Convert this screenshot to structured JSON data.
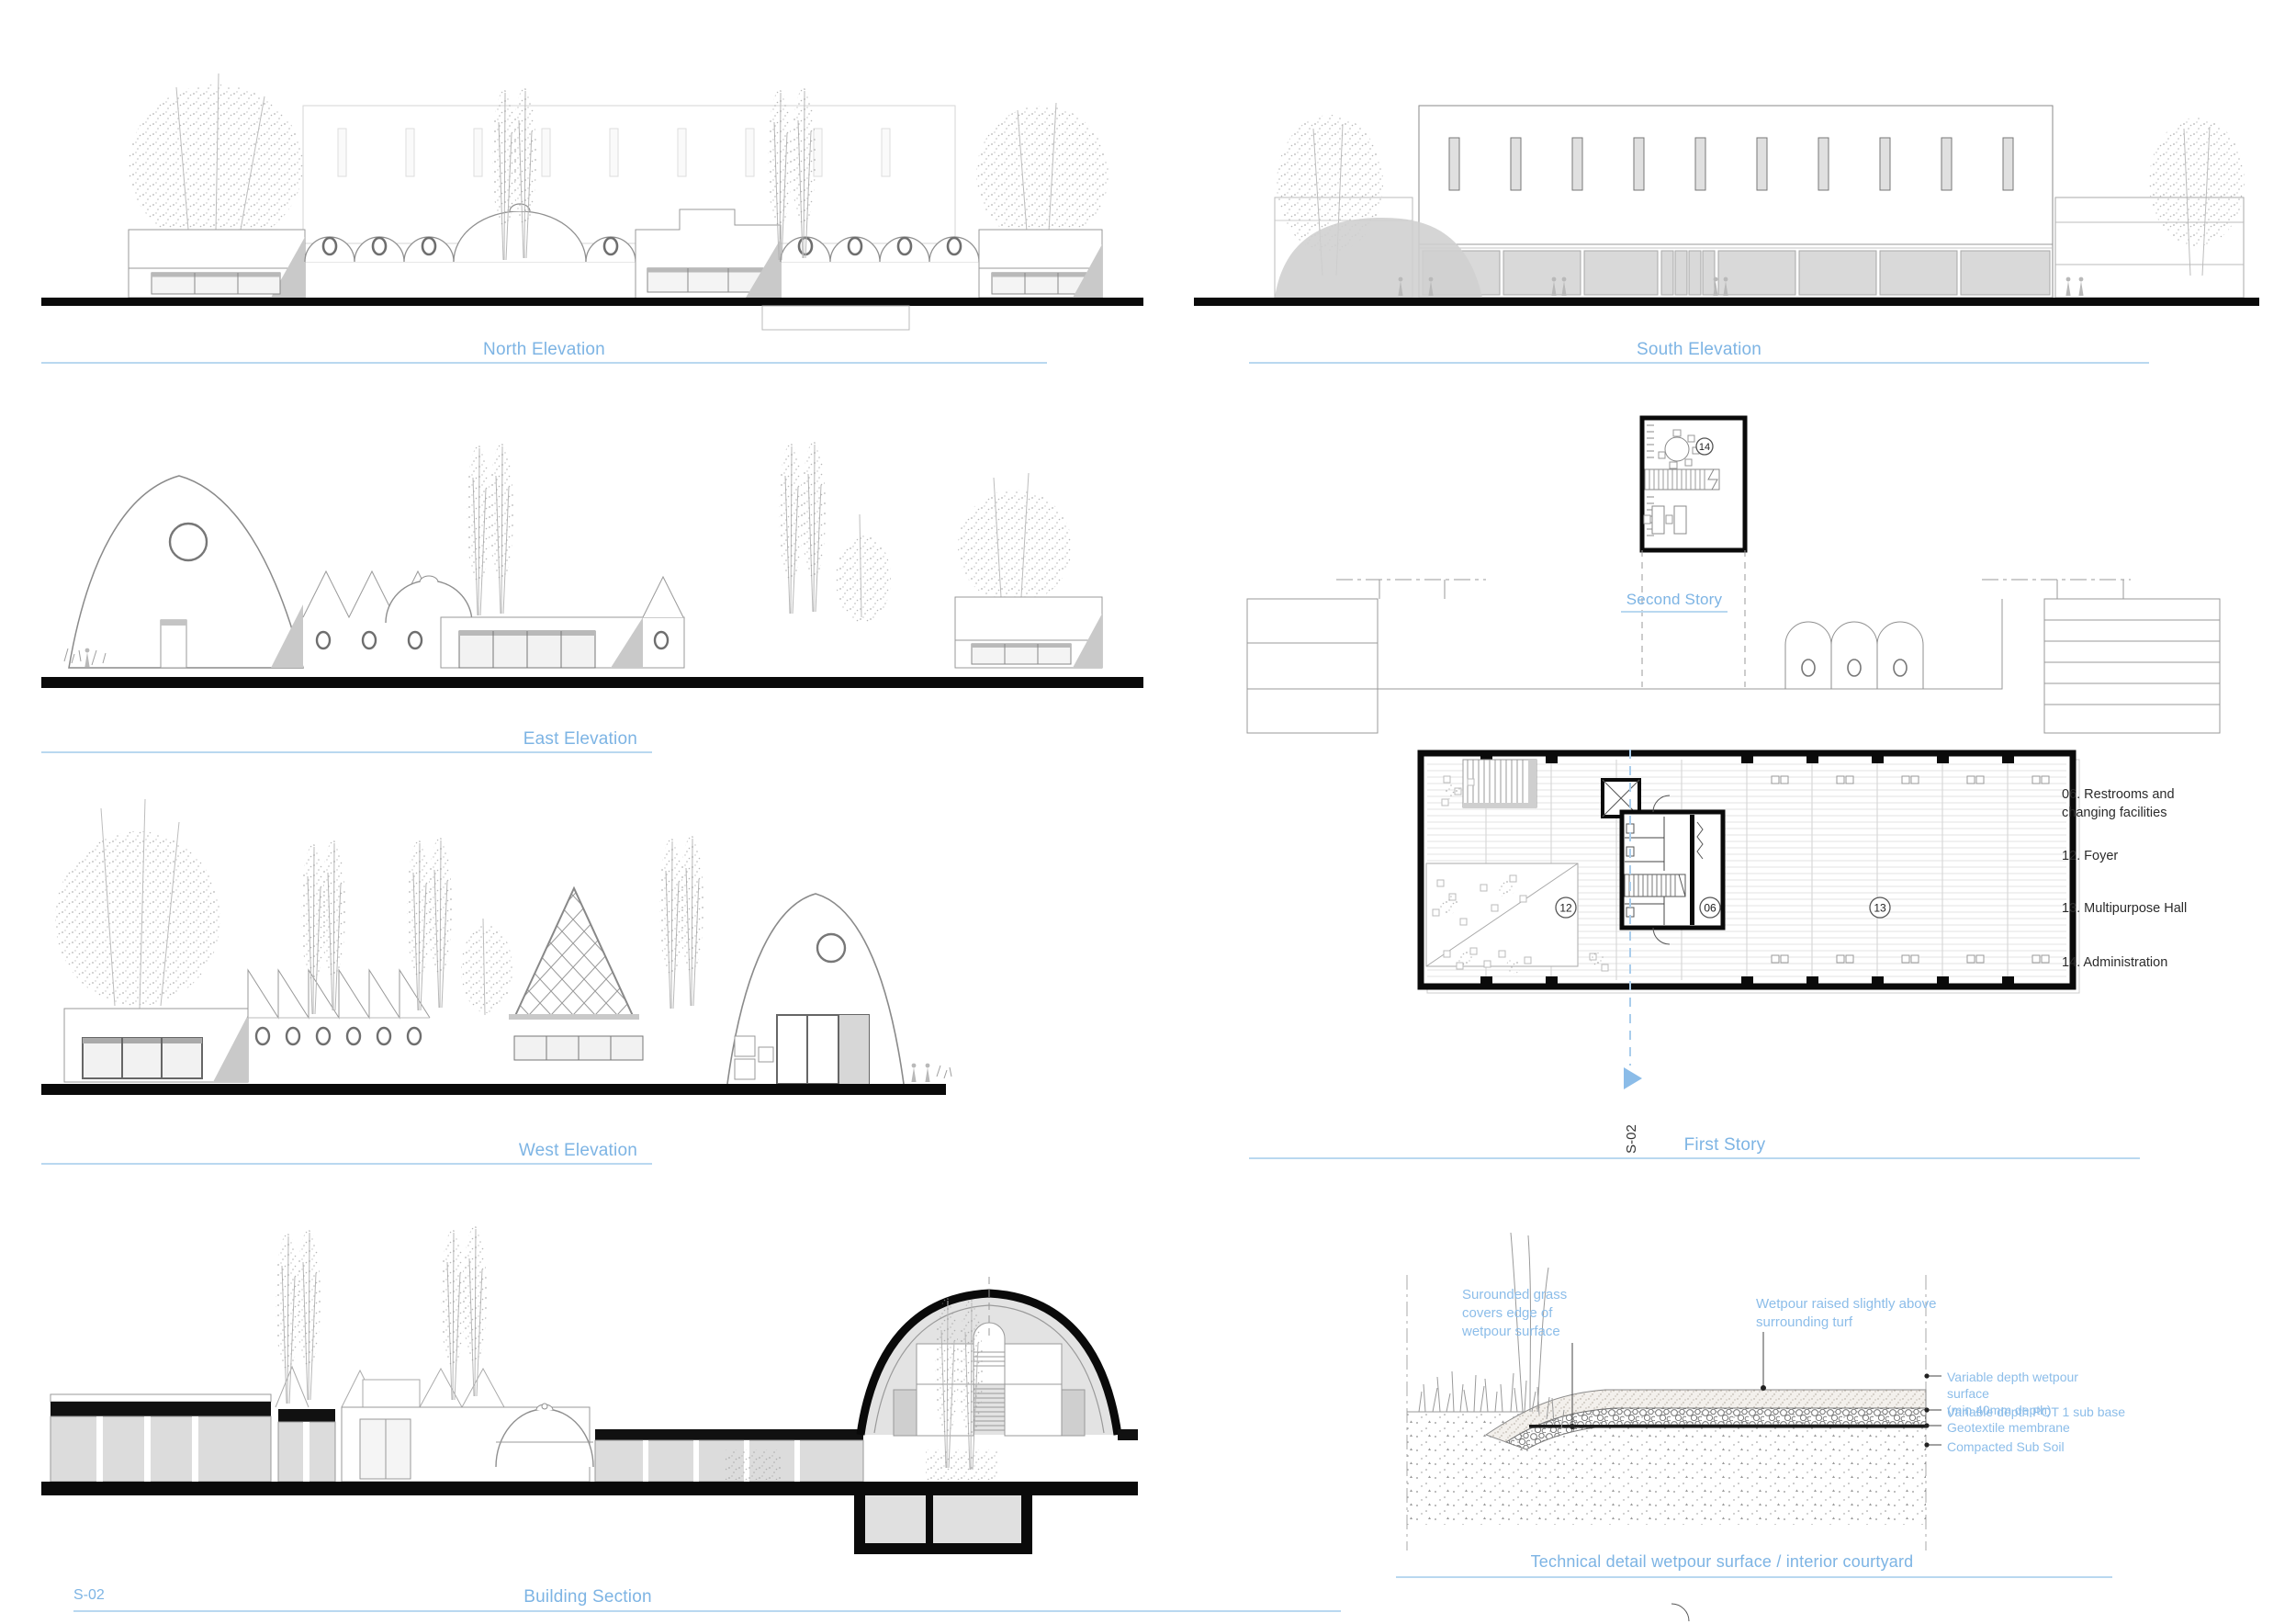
{
  "sheet": {
    "accent_color": "#7db4e4",
    "underline_color": "#b9d8f0",
    "panels": {
      "north_elevation": {
        "caption": "North Elevation"
      },
      "south_elevation": {
        "caption": "South Elevation"
      },
      "east_elevation": {
        "caption": "East Elevation"
      },
      "west_elevation": {
        "caption": "West Elevation"
      },
      "building_section": {
        "caption": "Building Section",
        "sheet_ref": "S-02"
      },
      "second_story": {
        "caption": "Second Story",
        "room_tag": "14"
      },
      "first_story": {
        "caption": "First Story",
        "section_marker": "S-02",
        "room_tags": {
          "foyer": "12",
          "restrooms": "06",
          "hall": "13"
        }
      },
      "legend": {
        "items": [
          "06. Restrooms and changing facilities",
          "12. Foyer",
          "13. Multipurpose Hall",
          "14. Administration"
        ]
      },
      "technical_detail": {
        "caption": "Technical detail wetpour surface / interior courtyard",
        "left_note": "Surounded grass\ncovers edge of\nwetpour surface",
        "top_note": "Wetpour raised slightly above\nsurrounding turf",
        "layers": [
          "Variable depth wetpour surface\n(min 40mm depth)",
          "Variable depth POT 1 sub base",
          "Geotextile membrane",
          "Compacted Sub Soil"
        ]
      }
    }
  }
}
